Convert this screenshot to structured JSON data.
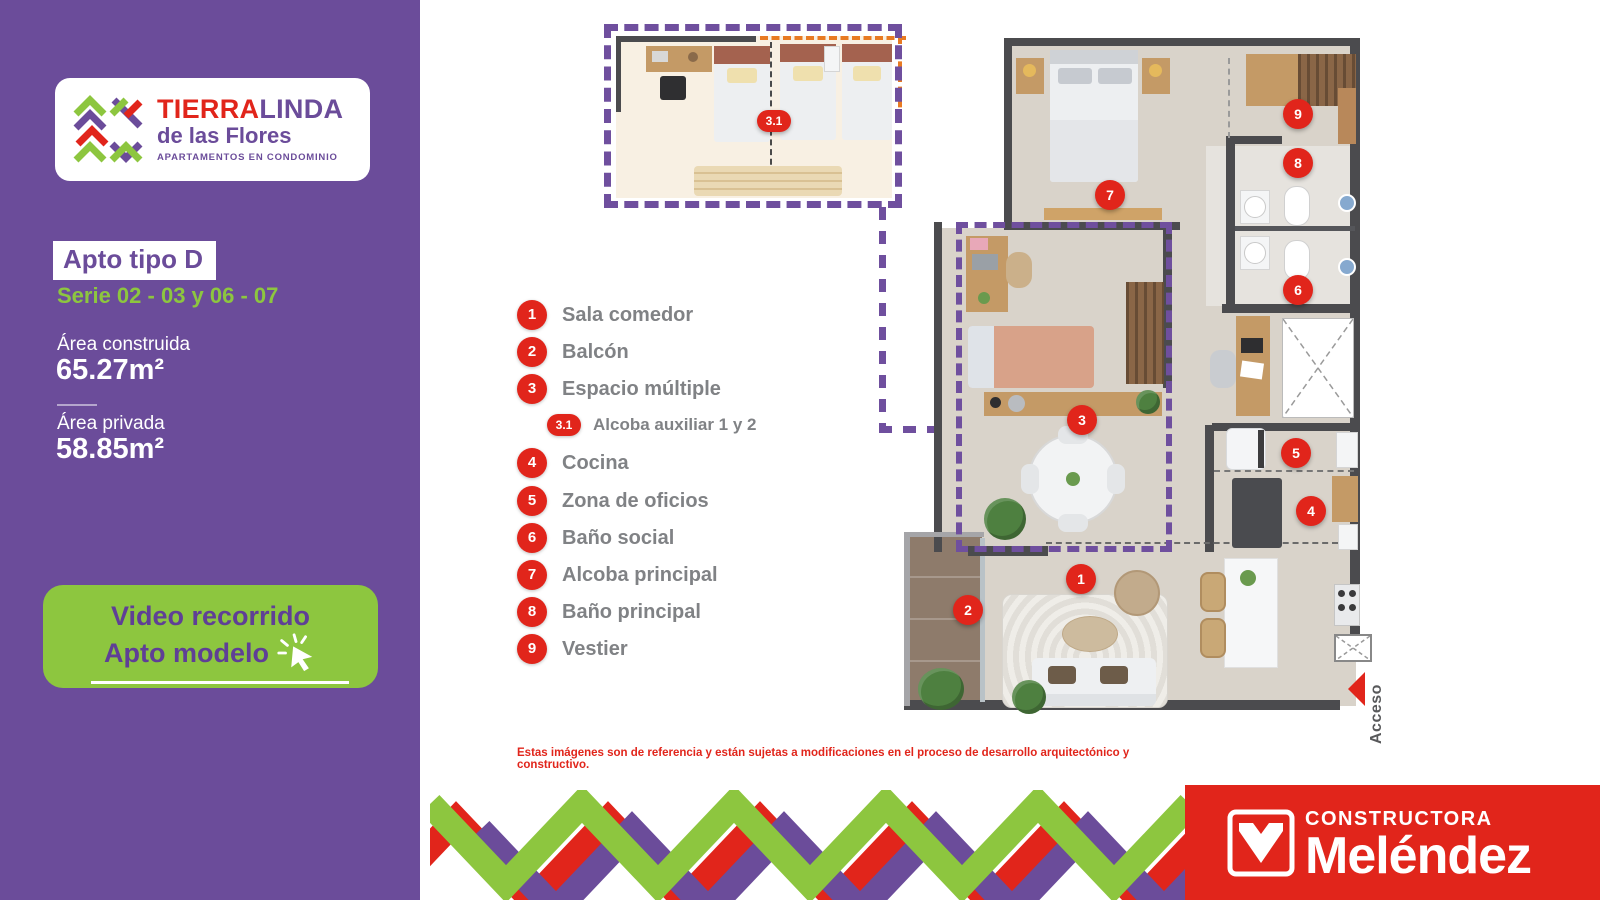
{
  "brand": {
    "name_part1": "TIERRA",
    "name_part2": "LINDA",
    "subtitle": "de las Flores",
    "tagline": "APARTAMENTOS EN CONDOMINIO"
  },
  "sidebar": {
    "apto_title": "Apto tipo D",
    "serie": "Serie 02 - 03 y 06 - 07",
    "area_construida_label": "Área construida",
    "area_construida_value": "65.27m²",
    "area_privada_label": "Área privada",
    "area_privada_value": "58.85m²",
    "video_button_line1": "Video recorrido",
    "video_button_line2": "Apto modelo"
  },
  "legend": {
    "items": [
      {
        "num": "1",
        "label": "Sala comedor"
      },
      {
        "num": "2",
        "label": "Balcón"
      },
      {
        "num": "3",
        "label": "Espacio múltiple"
      },
      {
        "num": "3.1",
        "label": "Alcoba auxiliar 1 y 2"
      },
      {
        "num": "4",
        "label": "Cocina"
      },
      {
        "num": "5",
        "label": "Zona de oficios"
      },
      {
        "num": "6",
        "label": "Baño social"
      },
      {
        "num": "7",
        "label": "Alcoba principal"
      },
      {
        "num": "8",
        "label": "Baño principal"
      },
      {
        "num": "9",
        "label": "Vestier"
      }
    ]
  },
  "plan": {
    "access_label": "Acceso",
    "badges": [
      {
        "num": "1"
      },
      {
        "num": "2"
      },
      {
        "num": "3"
      },
      {
        "num": "3.1"
      },
      {
        "num": "4"
      },
      {
        "num": "5"
      },
      {
        "num": "6"
      },
      {
        "num": "7"
      },
      {
        "num": "8"
      },
      {
        "num": "9"
      }
    ]
  },
  "footer": {
    "disclaimer": "Estas imágenes son de referencia y están sujetas a modificaciones en el proceso de desarrollo arquitectónico y constructivo.",
    "constructora": "CONSTRUCTORA",
    "melendez": "Meléndez"
  },
  "colors": {
    "purple": "#6b4c9a",
    "green": "#8dc63f",
    "red": "#e1251b",
    "legend_text": "#808285",
    "wall": "#4b4b4e",
    "floor": "#d9d3ca",
    "balcony": "#8e7b6b"
  }
}
